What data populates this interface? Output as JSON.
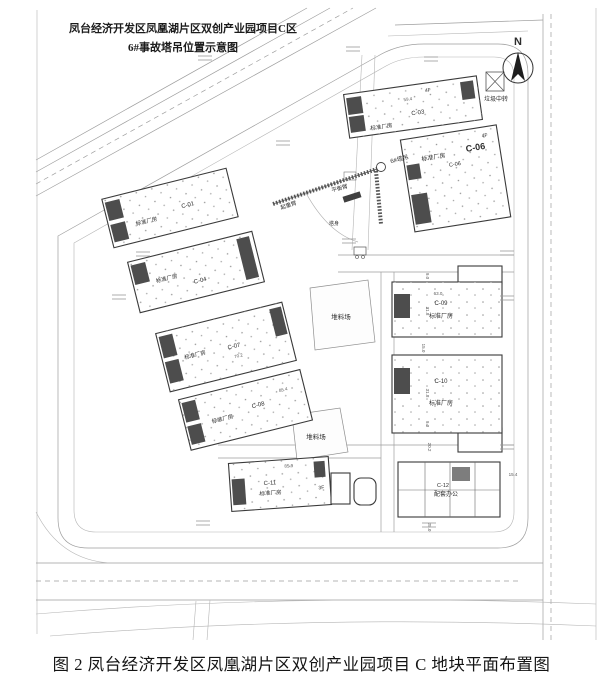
{
  "header": {
    "title_line1": "凤台经济开发区凤凰湖片区双创产业园项目C区",
    "title_line2": "6#事故塔吊位置示意图"
  },
  "caption": "图 2 凤台经济开发区凤凰湖片区双创产业园项目 C 地块平面布置图",
  "compass": {
    "north_label": "N"
  },
  "site": {
    "garbage_station": "垃圾中转",
    "stockyard_upper": "堆料场",
    "stockyard_lower": "堆料场"
  },
  "crane": {
    "name": "6#塔吊",
    "jib_label": "起重臂",
    "counterjib_label": "平衡臂",
    "mast_label": "塔身"
  },
  "buildings": {
    "c01": {
      "id": "C-01",
      "type": "标准厂房"
    },
    "c03": {
      "id": "C-03",
      "type": "标准厂房",
      "floors": "4F",
      "dim_top": "59.4"
    },
    "c04": {
      "id": "C-04",
      "type": "标准厂房"
    },
    "c06": {
      "id": "C-06",
      "type": "标准厂房",
      "id_small": "C-06",
      "floors": "4F"
    },
    "c07": {
      "id": "C-07",
      "type": "标准厂房",
      "dim": "70.2"
    },
    "c08": {
      "id": "C-08",
      "type": "标准厂房",
      "dim": "85.4"
    },
    "c09": {
      "id": "C-09",
      "type": "标准厂房",
      "dim_top": "63.0",
      "dim_side": "31.8",
      "dim_offset": "9.0"
    },
    "c10": {
      "id": "C-10",
      "type": "标准厂房",
      "dim_side": "31.8",
      "dim_offset": "9.0",
      "dim_gap": "15.0"
    },
    "c11": {
      "id": "C-11",
      "type": "标准厂房",
      "floors": "3F",
      "dim_top": "85.9"
    },
    "c12": {
      "id": "C-12",
      "type": "配套办公",
      "dim_right": "15.4",
      "dim_left": "25.0",
      "dim_top": "20.2"
    }
  }
}
